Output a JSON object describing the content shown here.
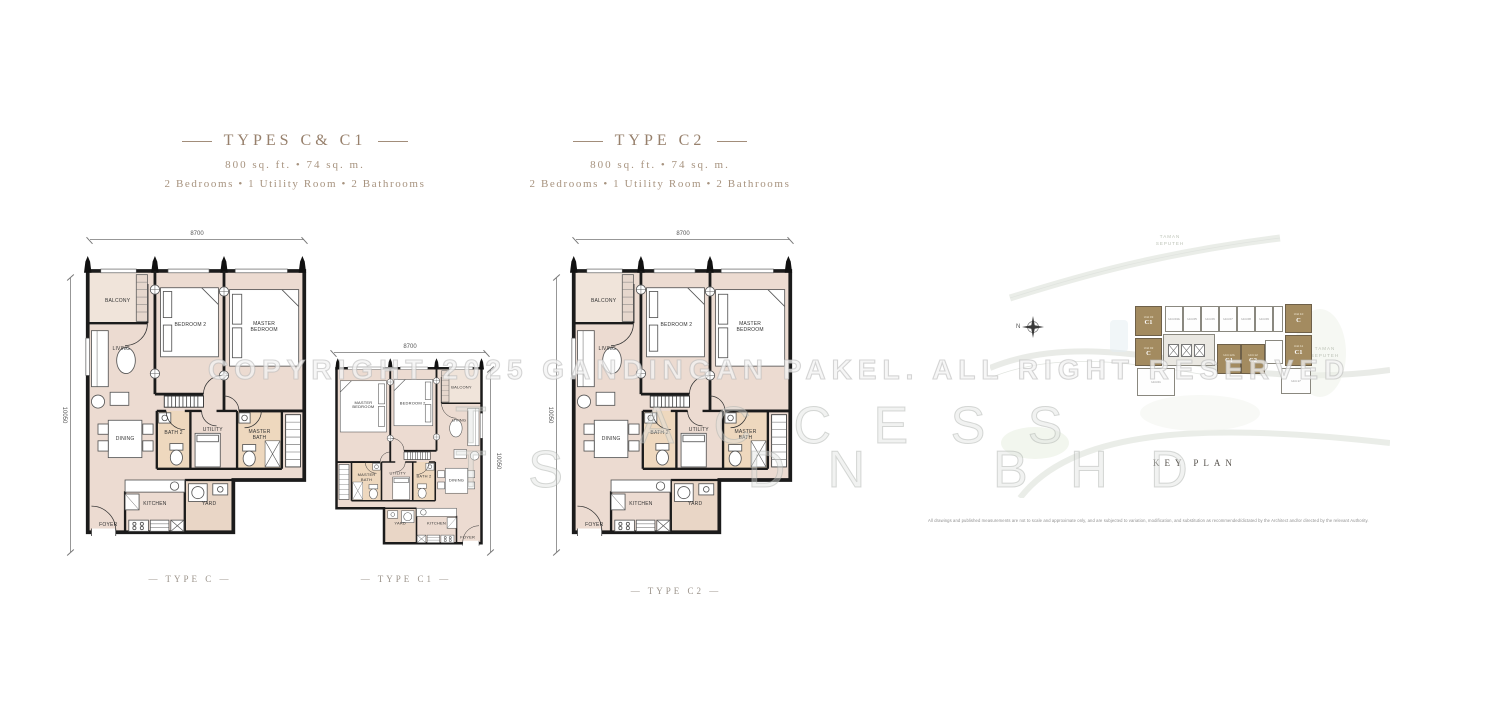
{
  "headers": {
    "c": {
      "title": "TYPES C& C1",
      "area": "800 sq. ft. • 74 sq. m.",
      "config": "2 Bedrooms • 1 Utility Room • 2 Bathrooms"
    },
    "c2": {
      "title": "TYPE C2",
      "area": "800 sq. ft. • 74 sq. m.",
      "config": "2 Bedrooms • 1 Utility Room • 2 Bathrooms"
    }
  },
  "plans": {
    "c": {
      "label": "— TYPE C —",
      "dim_top": "8700",
      "dim_side": "10050",
      "rooms": {
        "balcony": "BALCONY",
        "living": "LIVING",
        "bedroom2": "BEDROOM 2",
        "master_bedroom": "MASTER BEDROOM",
        "dining": "DINING",
        "bath2": "BATH 2",
        "utility": "UTILITY",
        "master_bath": "MASTER BATH",
        "kitchen": "KITCHEN",
        "yard": "YARD",
        "foyer": "FOYER"
      }
    },
    "c1": {
      "label": "— TYPE C1 —",
      "dim_top": "8700",
      "dim_side": "10050",
      "rooms": {
        "balcony": "BALCONY",
        "living": "LIVING",
        "bedroom2": "BEDROOM 2",
        "master_bedroom": "MASTER BEDROOM",
        "dining": "DINING",
        "bath2": "BATH 2",
        "utility": "UTILITY",
        "master_bath": "MASTER BATH",
        "kitchen": "KITCHEN",
        "yard": "YARD",
        "foyer": "FOYER"
      }
    },
    "c2": {
      "label": "— TYPE C2 —",
      "dim_top": "8700",
      "dim_side": "10050",
      "rooms": {
        "balcony": "BALCONY",
        "living": "LIVING",
        "bedroom2": "BEDROOM 2",
        "master_bedroom": "MASTER BEDROOM",
        "dining": "DINING",
        "bath2": "BATH 2",
        "utility": "UTILITY",
        "master_bath": "MASTER BATH",
        "kitchen": "KITCHEN",
        "yard": "YARD",
        "foyer": "FOYER"
      }
    }
  },
  "key_plan": {
    "label": "KEY PLAN",
    "north_label": "N",
    "area_top_1": "TAMAN",
    "area_top_2": "SEPUTEH",
    "area_right_1": "TAMAN",
    "area_right_2": "SEPUTEH",
    "highlight_color": "#a38b60",
    "units": {
      "left_top": {
        "no": "Unit 03",
        "type": "C1"
      },
      "left_bottom": {
        "no": "Unit 02",
        "type": "C"
      },
      "top_row": [
        "Unit 03A",
        "Unit 05",
        "Unit 06",
        "Unit 07",
        "Unit 08",
        "Unit 09"
      ],
      "right_top": {
        "no": "Unit 10",
        "type": "C"
      },
      "right_bottom": {
        "no": "Unit 11",
        "type": "C1"
      },
      "mid_left": {
        "no": "Unit 12A",
        "type": "C1"
      },
      "mid_right": {
        "no": "Unit 12",
        "type": "C2"
      },
      "bottom_left": "Unit 01",
      "bottom_right": "Unit 17"
    }
  },
  "watermarks": {
    "copyright": "COPYRIGHT 2025 GANDINGAN PAKEL. ALL RIGHT RESERVED",
    "letters_row1": "T     A C C E S S",
    "letters_row2": "T S      D N    B H D"
  },
  "disclaimer": "All drawings and published measurements are not to scale and approximate only, and are subjected to variation, modification, and substitution as recommended/dictated by the Architect and/or directed by the relevant Authority."
}
